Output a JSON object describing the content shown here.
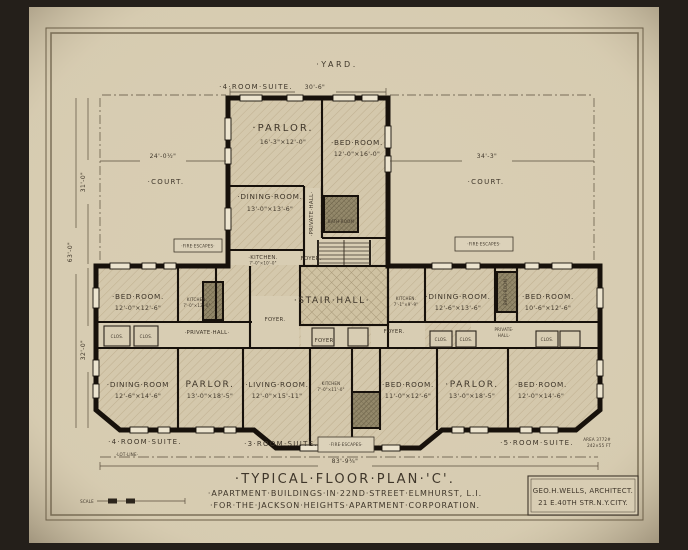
{
  "colors": {
    "photo_background": "#241f1a",
    "paper": "#d8cdb3",
    "ink": "#3f362a",
    "wall": "#17110b"
  },
  "site": {
    "yard": "·YARD.",
    "court_left": "·COURT.",
    "court_right": "·COURT.",
    "lot_line": "·LOT·LINE·"
  },
  "suites": {
    "top": "·4·ROOM·SUITE.",
    "bottom_left": "·4·ROOM·SUITE.",
    "bottom_center": "·3·ROOM·SUITE.",
    "bottom_right": "·5·ROOM·SUITE."
  },
  "dimensions": {
    "wing_width": "30'-6\"",
    "court_left": "24'-0½\"",
    "court_right": "34'-3\"",
    "left_upper": "31'-0\"",
    "left_total": "63'-0\"",
    "left_lower": "32'-0\"",
    "frontage": "83'-9¾\""
  },
  "rooms": {
    "parlor_top": {
      "name": "·PARLOR.",
      "size": "16'-3\"×12'-0\""
    },
    "bedroom_top": {
      "name": "·BED·ROOM.",
      "size": "12'-0\"×16'-0\""
    },
    "dining_top": {
      "name": "·DINING·ROOM.",
      "size": "13'-0\"×13'-6\""
    },
    "private_hall_top": {
      "name": "·PRIVATE·HALL·"
    },
    "bath_top": {
      "name": "BATH·ROOM"
    },
    "kitchen_upper": {
      "name": "·KITCHEN.",
      "size": "7'-0\"×10'-0\""
    },
    "foyer_upper": {
      "name": "FOYER."
    },
    "stair_hall": {
      "name": "·STAIR·HALL·"
    },
    "bedroom_mid_left": {
      "name": "·BED·ROOM.",
      "size": "12'-0\"×12'-6\""
    },
    "kitchen_mid_left": {
      "name": "KITCHEN.",
      "size": "7'-0\"×12'-0\""
    },
    "private_hall_left": {
      "name": "·PRIVATE·HALL·"
    },
    "foyer_mid_left": {
      "name": "FOYER."
    },
    "foyer_lower_left": {
      "name": "FOYER."
    },
    "kitchen_mid_right": {
      "name": "KITCHEN.",
      "size": "7'-1\"×9'-9\""
    },
    "foyer_mid_right": {
      "name": "FOYER."
    },
    "dining_mid_right": {
      "name": "·DINING·ROOM.",
      "size": "12'-6\"×13'-6\""
    },
    "bedroom_mid_right": {
      "name": "·BED·ROOM.",
      "size": "10'-6\"×12'-6\""
    },
    "private_hall_right": {
      "line1": "PRIVATE·",
      "line2": "HALL·"
    },
    "bath_right": {
      "name": "BATH·ROOM"
    },
    "dining_bottom_left": {
      "name": "·DINING·ROOM",
      "size": "12'-6\"×14'-6\""
    },
    "parlor_bottom_left": {
      "name": "PARLOR.",
      "size": "13'-0\"×18'-5\""
    },
    "living_bottom": {
      "name": "·LIVING·ROOM.",
      "size": "12'-0\"×15'-11\""
    },
    "kitchen_bottom": {
      "name": "KITCHEN",
      "size": "7'-0\"×11'-0\""
    },
    "bedroom_bottom_center": {
      "name": "·BED·ROOM.",
      "size": "11'-0\"×12'-6\""
    },
    "parlor_bottom_right": {
      "name": "·PARLOR.",
      "size": "13'-0\"×18'-5\""
    },
    "bedroom_bottom_right": {
      "name": "·BED·ROOM.",
      "size": "12'-0\"×14'-6\""
    }
  },
  "annotations": {
    "fire_escapes": "·FIRE·ESCAPES·",
    "closet": "CLOS.",
    "scale_label": "SCALE",
    "area_note_line1": "AREA 3772#",
    "area_note_line2": "242×55 FT"
  },
  "title_block": {
    "line1": "·TYPICAL·FLOOR·PLAN·'C'.",
    "line2": "·APARTMENT·BUILDINGS·IN·22ND·STREET·ELMHURST, L.I.",
    "line3": "·FOR·THE·JACKSON·HEIGHTS·APARTMENT·CORPORATION."
  },
  "architect_block": {
    "line1": "GEO.H.WELLS, ARCHITECT.",
    "line2": "21 E.40TH STR.N.Y.CITY."
  }
}
